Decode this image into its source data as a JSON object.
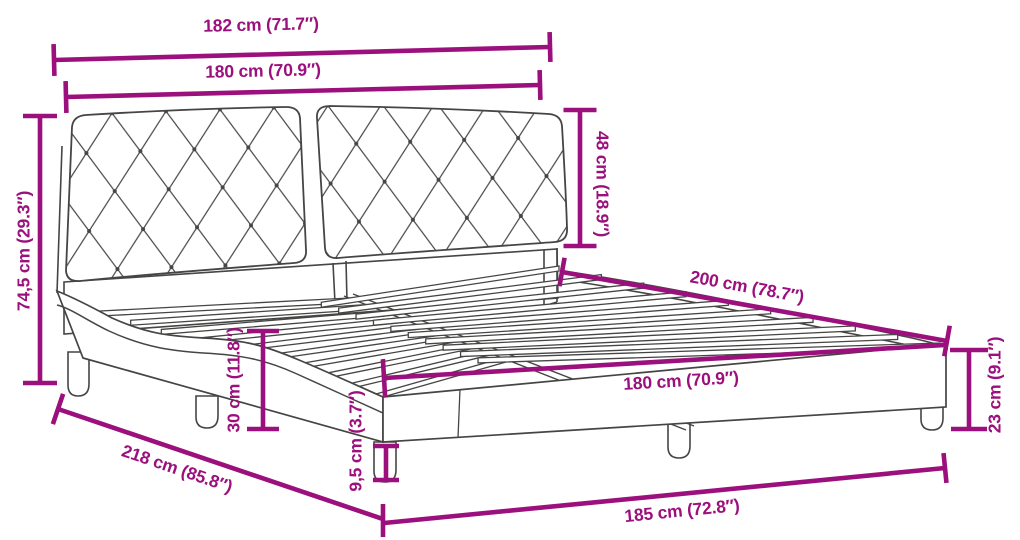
{
  "diagram": {
    "type": "product-dimension-drawing",
    "subject": "bed-frame-with-tufted-headboard-and-slats",
    "accent_color": "#9B107D",
    "line_color": "#454544",
    "background_color": "#ffffff",
    "dimensions": [
      {
        "id": "overall-width-top",
        "label": "182 cm (71.7″)",
        "value_cm": 182,
        "value_in": 71.7
      },
      {
        "id": "headboard-width",
        "label": "180 cm (70.9″)",
        "value_cm": 180,
        "value_in": 70.9
      },
      {
        "id": "headboard-cushion-height",
        "label": "48 cm (18.9″)",
        "value_cm": 48,
        "value_in": 18.9
      },
      {
        "id": "overall-height",
        "label": "74,5 cm (29.3″)",
        "value_cm": 74.5,
        "value_in": 29.3
      },
      {
        "id": "bed-length-inner",
        "label": "200 cm (78.7″)",
        "value_cm": 200,
        "value_in": 78.7
      },
      {
        "id": "frame-side-height",
        "label": "30 cm (11.8″)",
        "value_cm": 30,
        "value_in": 11.8
      },
      {
        "id": "bed-width-inner",
        "label": "180 cm (70.9″)",
        "value_cm": 180,
        "value_in": 70.9
      },
      {
        "id": "footend-height",
        "label": "23 cm (9.1″)",
        "value_cm": 23,
        "value_in": 9.1
      },
      {
        "id": "overall-length-diagonal",
        "label": "218 cm (85.8″)",
        "value_cm": 218,
        "value_in": 85.8
      },
      {
        "id": "leg-height",
        "label": "9,5 cm (3.7″)",
        "value_cm": 9.5,
        "value_in": 3.7
      },
      {
        "id": "overall-length-bottom",
        "label": "185 cm (72.8″)",
        "value_cm": 185,
        "value_in": 72.8
      }
    ]
  }
}
